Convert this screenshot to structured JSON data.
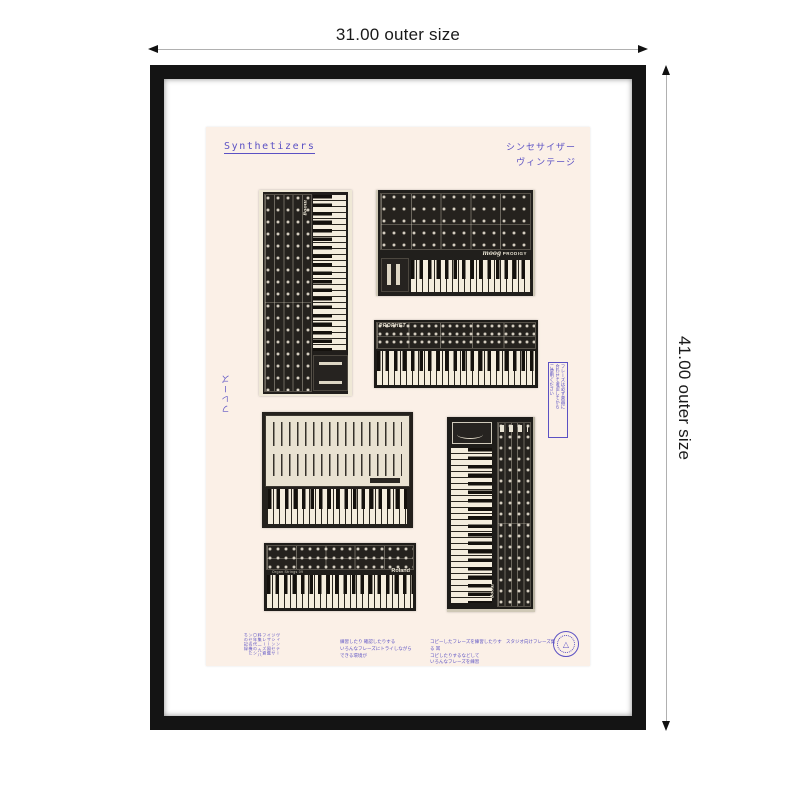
{
  "colors": {
    "accent_blue": "#5b51c4",
    "frame_black": "#141414",
    "matte_white": "#ffffff",
    "poster_cream": "#fbf0e7",
    "synth_dark": "#211e1b",
    "key_ivory": "#f4eddd"
  },
  "dimensions": {
    "top_label": "31.00 outer size",
    "right_label": "41.00 outer size"
  },
  "poster": {
    "title": "Synthetizers",
    "subtitle_jp": {
      "line1": "シンセサイザー",
      "line2": "ヴィンテージ"
    },
    "side_left_text": "フレーズ",
    "side_right_box": {
      "col1": "フレーズは必ず楽器に",
      "col2": "合わせて確認してから",
      "col3": "ご使用ください"
    },
    "synths": [
      {
        "name": "moog vertical synth",
        "brand": "moog"
      },
      {
        "name": "moog prodigy",
        "brand": "moog",
        "model": "PRODIGY"
      },
      {
        "name": "prophet",
        "brand": "PROPHET"
      },
      {
        "name": "arp odyssey"
      },
      {
        "name": "roland organ strings",
        "brand": "Roland",
        "model": "Organ Strings 09"
      },
      {
        "name": "moog vertical synth 2",
        "brand": "moog"
      }
    ],
    "footer": {
      "left_block_line1": "ヴィンテージシンセサイザー図鑑フレーズ資料集",
      "left_block_line2": "一九八〇年代のシンセ名機たちの記録",
      "p1_line1": "練習したり 確認したりする",
      "p1_line2": "いろんなフレーズにトライしながら",
      "p1_line3": "できる環境が",
      "p2_line1": "コピーしたフレーズを練習したりする 耳",
      "p2_line2": "コピしたりするなどして",
      "p2_line3": "いろんなフレーズを練習",
      "p3_line1": "スタジオ向けフレーズ集",
      "stamp_glyph": "△"
    }
  }
}
